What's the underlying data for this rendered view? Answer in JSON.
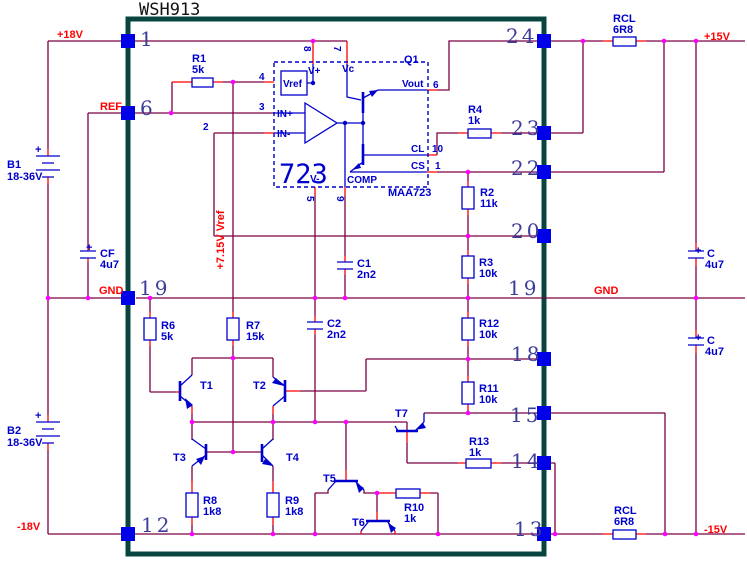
{
  "title": "WSH913",
  "rails": {
    "plus18": "+18V",
    "ref": "REF",
    "gnd_left": "GND",
    "minus18": "-18V",
    "plus15": "+15V",
    "gnd_right": "GND",
    "minus15": "-15V",
    "vref_rail": "+7.15V Vref"
  },
  "pins": {
    "left": {
      "p1": "1",
      "p6": "6",
      "p19": "19",
      "p12": "12"
    },
    "right": {
      "p24": "24",
      "p23": "23",
      "p22": "22",
      "p20": "20",
      "p19": "19",
      "p18": "18",
      "p15": "15",
      "p14": "14",
      "p13": "13"
    }
  },
  "ic": {
    "big_label": "723",
    "part": "MAA723",
    "q1": "Q1",
    "labels": {
      "vref": "Vref",
      "vplus": "V+",
      "vc": "Vc",
      "inplus": "IN+",
      "inminus": "IN-",
      "vminus": "V-",
      "comp": "COMP",
      "vout": "Vout",
      "cl": "CL",
      "cs": "CS"
    },
    "pin_numbers": {
      "p8": "8",
      "p7": "7",
      "p4": "4",
      "p3": "3",
      "p2": "2",
      "p6": "6",
      "p10": "10",
      "p1": "1",
      "p5": "5",
      "p9": "9"
    }
  },
  "components": {
    "r1": {
      "ref": "R1",
      "value": "5k"
    },
    "rcl_top": {
      "ref": "RCL",
      "value": "6R8"
    },
    "r4": {
      "ref": "R4",
      "value": "1k"
    },
    "r2": {
      "ref": "R2",
      "value": "11k"
    },
    "r3": {
      "ref": "R3",
      "value": "10k"
    },
    "r12": {
      "ref": "R12",
      "value": "10k"
    },
    "r11": {
      "ref": "R11",
      "value": "10k"
    },
    "r13": {
      "ref": "R13",
      "value": "1k"
    },
    "rcl_bottom": {
      "ref": "RCL",
      "value": "6R8"
    },
    "r6": {
      "ref": "R6",
      "value": "5k"
    },
    "r7": {
      "ref": "R7",
      "value": "15k"
    },
    "r8": {
      "ref": "R8",
      "value": "1k8"
    },
    "r9": {
      "ref": "R9",
      "value": "1k8"
    },
    "r10": {
      "ref": "R10",
      "value": "1k"
    },
    "c1": {
      "ref": "C1",
      "value": "2n2"
    },
    "c2": {
      "ref": "C2",
      "value": "2n2"
    },
    "cf": {
      "ref": "CF",
      "value": "4u7",
      "polarity": "+"
    },
    "c_top": {
      "ref": "C",
      "value": "4u7",
      "polarity": "+"
    },
    "c_bottom": {
      "ref": "C",
      "value": "4u7",
      "polarity": "+"
    },
    "b1": {
      "ref": "B1",
      "value": "18-36V",
      "polarity": "+"
    },
    "b2": {
      "ref": "B2",
      "value": "18-36V",
      "polarity": "+"
    },
    "t1": {
      "ref": "T1"
    },
    "t2": {
      "ref": "T2"
    },
    "t3": {
      "ref": "T3"
    },
    "t4": {
      "ref": "T4"
    },
    "t5": {
      "ref": "T5"
    },
    "t6": {
      "ref": "T6"
    },
    "t7": {
      "ref": "T7"
    }
  },
  "colors": {
    "wire": "#7C0045",
    "lead": "#FF0000",
    "component": "#0000CC",
    "junction": "#FF00FF",
    "border": "#084440",
    "pin_square": "#0000E8",
    "pin_number": "#3C3C99",
    "net_label": "#FF0000"
  }
}
